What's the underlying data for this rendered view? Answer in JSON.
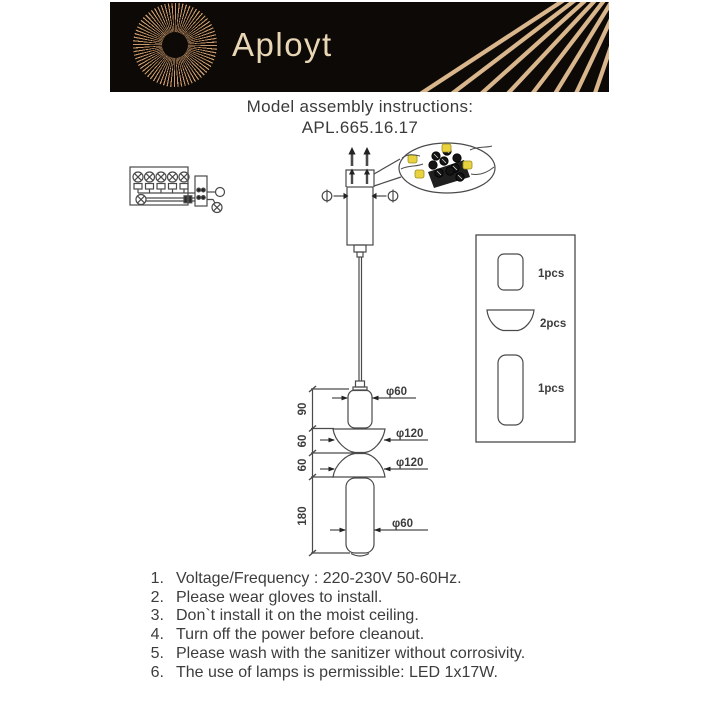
{
  "brand": {
    "name": "Aployt"
  },
  "title": {
    "line1": "Model assembly instructions:",
    "line2": "APL.665.16.17"
  },
  "colors": {
    "banner_bg": "#0d0906",
    "gold_rays": "#c9996b",
    "gold_text": "#e9d6b4",
    "line_art": "#4a4a4a",
    "highlight_yellow": "#e8d23e"
  },
  "diagram": {
    "dimensions": {
      "seg_top_cylinder": "90",
      "seg_upper_bowl": "60",
      "seg_lower_bowl": "60",
      "seg_bottom_cylinder": "180",
      "dia_top_cylinder": "φ60",
      "dia_upper_bowl": "φ120",
      "dia_lower_bowl": "φ120",
      "dia_bottom_cylinder": "φ60"
    },
    "parts_list": [
      {
        "label": "1pcs"
      },
      {
        "label": "2pcs"
      },
      {
        "label": "1pcs"
      }
    ]
  },
  "instructions": [
    {
      "num": "1.",
      "text": "Voltage/Frequency : 220-230V 50-60Hz."
    },
    {
      "num": "2.",
      "text": "Please wear gloves to install."
    },
    {
      "num": "3.",
      "text": "Don`t install it on the moist ceiling."
    },
    {
      "num": "4.",
      "text": "Turn off the power before cleanout."
    },
    {
      "num": "5.",
      "text": "Please wash with the sanitizer without corrosivity."
    },
    {
      "num": "6.",
      "text": "The use of lamps is permissible: LED 1x17W."
    }
  ]
}
